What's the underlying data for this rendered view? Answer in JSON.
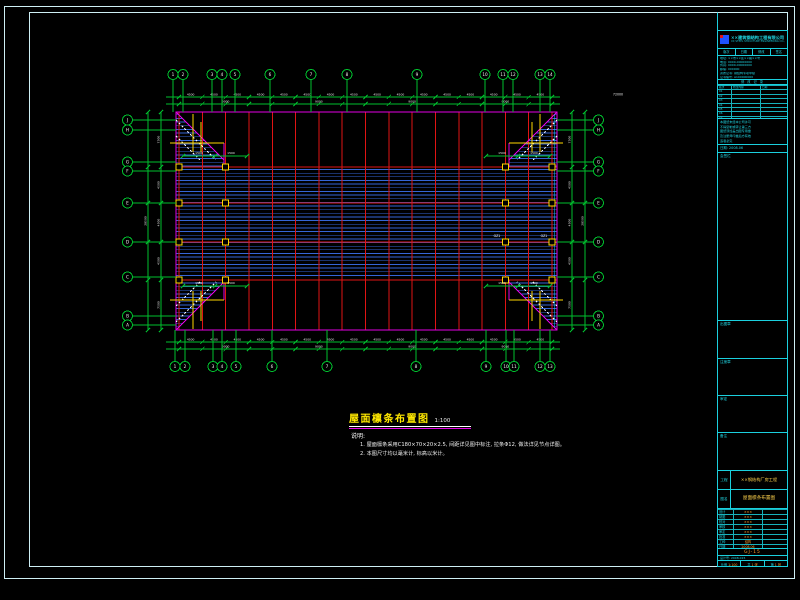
{
  "sheet": {
    "frame_color": "#cdeef4",
    "line_color": "#1bd0de",
    "bg": "#000000"
  },
  "colors": {
    "red": "#e01414",
    "purlin": "#3565d6",
    "magenta": "#e400e4",
    "green": "#00bf2e",
    "yellow": "#ffd700",
    "white": "#ededed",
    "cyan": "#18c8ff",
    "orange": "#ff9e2a"
  },
  "drawing": {
    "title": "屋面檩条布置图",
    "scale": "1:100",
    "notes_label": "说明:",
    "notes": [
      "1. 屋面檩条采用C180×70×20×2.5, 间距详见图中标注, 拉条Φ12, 做法详见节点详图。",
      "2. 本图尺寸均以毫米计, 标高以米计。"
    ],
    "column_tag": "GZ1",
    "axes": {
      "top_labels": [
        "1",
        "2",
        "3",
        "4",
        "5",
        "6",
        "7",
        "8",
        "9",
        "10",
        "11",
        "12",
        "13",
        "14"
      ],
      "bottom_labels": [
        "1",
        "2",
        "3",
        "4",
        "5",
        "6",
        "7",
        "8",
        "9",
        "10",
        "11",
        "12",
        "13"
      ],
      "left_labels": [
        "J",
        "H",
        "G",
        "F",
        "E",
        "D",
        "C",
        "B",
        "A"
      ],
      "right_labels": [
        "J",
        "H",
        "G",
        "F",
        "E",
        "D",
        "C",
        "B",
        "A"
      ]
    },
    "dims": {
      "bay": "4500",
      "group": "9000",
      "total_w": "72000",
      "bands": [
        "7500",
        "4500",
        "4500",
        "4500",
        "7500"
      ],
      "total_h": "28500",
      "corner": "1500"
    }
  },
  "titleblock": {
    "company_cn": "××建筑钢结构工程有限公司",
    "company_en": "XX STEEL STRUCTURE ENGINEERING CO.,LTD.",
    "header_cells": [
      "版次",
      "日期",
      "修改",
      "签名"
    ],
    "info_lines": [
      "地址: ××市××区××路××号",
      "电话: 0000-00000000",
      "传真: 0000-00000000",
      "邮编: 000000",
      "资质证书: 钢结构专项甲级",
      "证书编号: A100000000"
    ],
    "revision_title": "修 改 记 录",
    "revision_header": [
      "版次",
      "修改内容",
      "日期"
    ],
    "revision_rows": [
      "01",
      "02",
      "03",
      "04",
      "05",
      "06",
      "07"
    ],
    "cert_lines": [
      "本图纸未经本公司许可",
      "不得复制或转让第三方",
      "图纸须加盖出图专用章",
      "及注册师印章后方有效",
      "违者必究"
    ],
    "date_line": "日期: 2008.06",
    "stamp_boxes": [
      "会签栏",
      "出图章",
      "注册章",
      "审定",
      "备注"
    ],
    "project_label": "工程",
    "project_value": "××钢结构厂房工程",
    "name_label": "图名",
    "name_value": "屋面檩条布置图",
    "fields": [
      {
        "label": "设计",
        "value": "×××"
      },
      {
        "label": "制图",
        "value": "×××"
      },
      {
        "label": "校对",
        "value": "×××"
      },
      {
        "label": "审核",
        "value": "×××"
      },
      {
        "label": "审定",
        "value": "×××"
      },
      {
        "label": "批准",
        "value": "×××"
      },
      {
        "label": "工种",
        "value": "结构"
      },
      {
        "label": "日期",
        "value": "2008.06"
      }
    ],
    "drawing_no": "GJ-15",
    "design_no_line": "设计号: 2008-015",
    "scale_cells": [
      {
        "label": "比例",
        "value": "1:100"
      },
      {
        "label": "共",
        "value": "1 张"
      },
      {
        "label": "第",
        "value": "1 张"
      }
    ]
  }
}
